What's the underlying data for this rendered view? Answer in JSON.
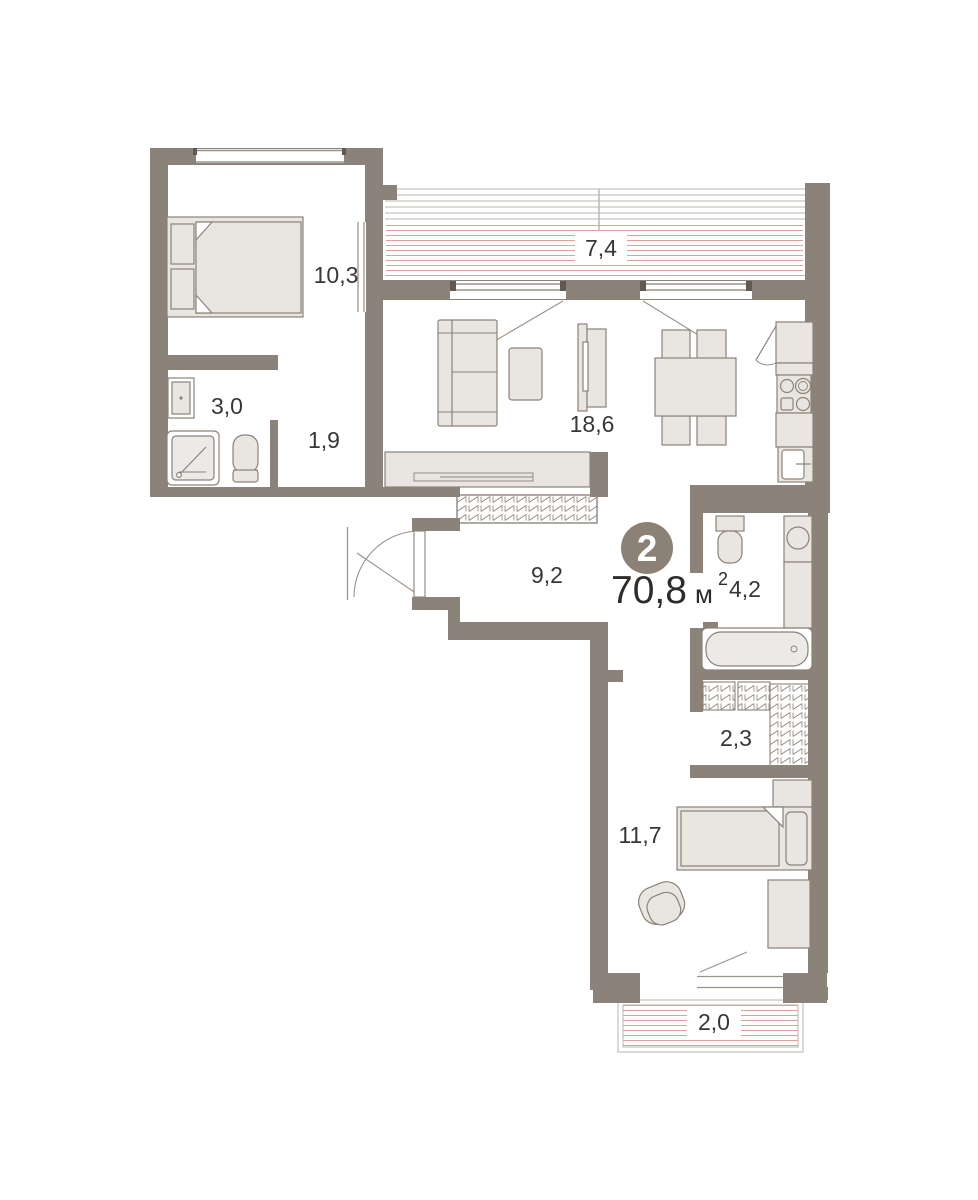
{
  "plan": {
    "badge": {
      "number": "2"
    },
    "total_area": {
      "value": "70,8",
      "unit": "м",
      "sup": "2"
    },
    "rooms": [
      {
        "name": "bedroom-main",
        "area": "10,3"
      },
      {
        "name": "loggia-top",
        "area": "7,4"
      },
      {
        "name": "bathroom-shower",
        "area": "3,0"
      },
      {
        "name": "hall-small",
        "area": "1,9"
      },
      {
        "name": "living-kitchen",
        "area": "18,6"
      },
      {
        "name": "hallway",
        "area": "9,2"
      },
      {
        "name": "bathroom-bath",
        "area": "4,2"
      },
      {
        "name": "wardrobe-room",
        "area": "2,3"
      },
      {
        "name": "bedroom-second",
        "area": "11,7"
      },
      {
        "name": "loggia-bottom",
        "area": "2,0"
      }
    ],
    "colors": {
      "wall": "#8b8279",
      "furniture_fill": "#e9e6e2",
      "hatch_red": "#dfa19b",
      "glazing_line": "#b9b4ae",
      "badge_fill": "#8b8177",
      "text": "#3a3633"
    }
  }
}
